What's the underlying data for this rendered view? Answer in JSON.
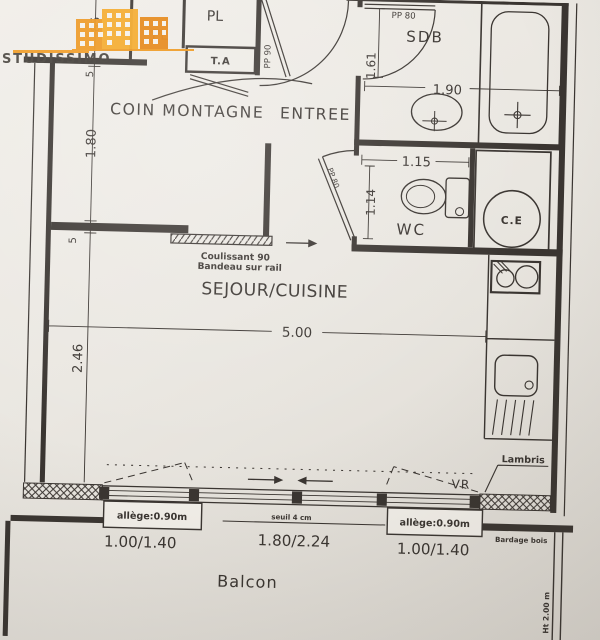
{
  "logo": {
    "brand": "STUDISSIMO"
  },
  "rooms": {
    "coin_montagne": "COIN MONTAGNE",
    "entree": "ENTREE",
    "sdb": "SDB",
    "wc": "WC",
    "sejour": "SEJOUR/CUISINE",
    "balcon": "Balcon",
    "pl_left": "PL",
    "pl_right": "PL",
    "ta": "T.A",
    "ce": "C.E"
  },
  "doors": {
    "entry": "PP 90",
    "sdb": "PP 80",
    "wc": "PP 80"
  },
  "dimensions": {
    "closet_height": "85",
    "wall_top": "5",
    "coin_width": "1.80",
    "wall_mid": "5",
    "sejour_height": "2.46",
    "sdb_left": "1.61",
    "sdb_width": "1.90",
    "wc_width": "1.15",
    "wc_height": "1.14",
    "sejour_width": "5.00"
  },
  "annotations": {
    "sliding_door": "Coulissant 90",
    "sliding_rail": "Bandeau sur rail",
    "lambris": "Lambris",
    "vr": "VR",
    "allege_left": "allège:0.90m",
    "allege_right": "allège:0.90m",
    "seuil": "seuil 4 cm",
    "bardage": "Bardage bois",
    "separation_height": "Ht 2.00 m"
  },
  "windows": {
    "left": "1.00/1.40",
    "middle": "1.80/2.24",
    "right": "1.00/1.40"
  },
  "colors": {
    "paper": "#eae7e1",
    "ink": "#3a3531",
    "logo_orange": "#f0a132"
  }
}
